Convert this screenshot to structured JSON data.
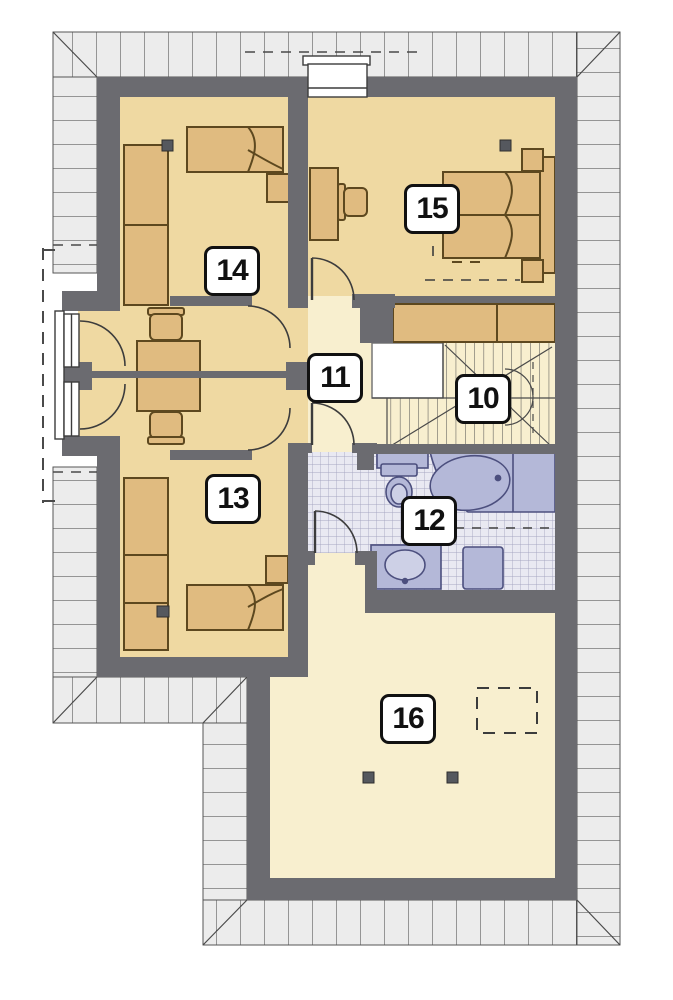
{
  "floor_plan": {
    "rooms": [
      {
        "number": "10"
      },
      {
        "number": "11"
      },
      {
        "number": "12"
      },
      {
        "number": "13"
      },
      {
        "number": "14"
      },
      {
        "number": "15"
      },
      {
        "number": "16"
      }
    ],
    "colors": {
      "wall": "#6b6b70",
      "room_floor": "#efd9a2",
      "hall_floor": "#f8efcf",
      "furniture": "#e0bb80",
      "furniture_outline": "#5d481f",
      "roof_band": "#ececec",
      "bath_fixture": "#b4b8d8",
      "bath_fixture_outline": "#4c4f7e",
      "bath_tile": "#e9e9f2"
    }
  }
}
